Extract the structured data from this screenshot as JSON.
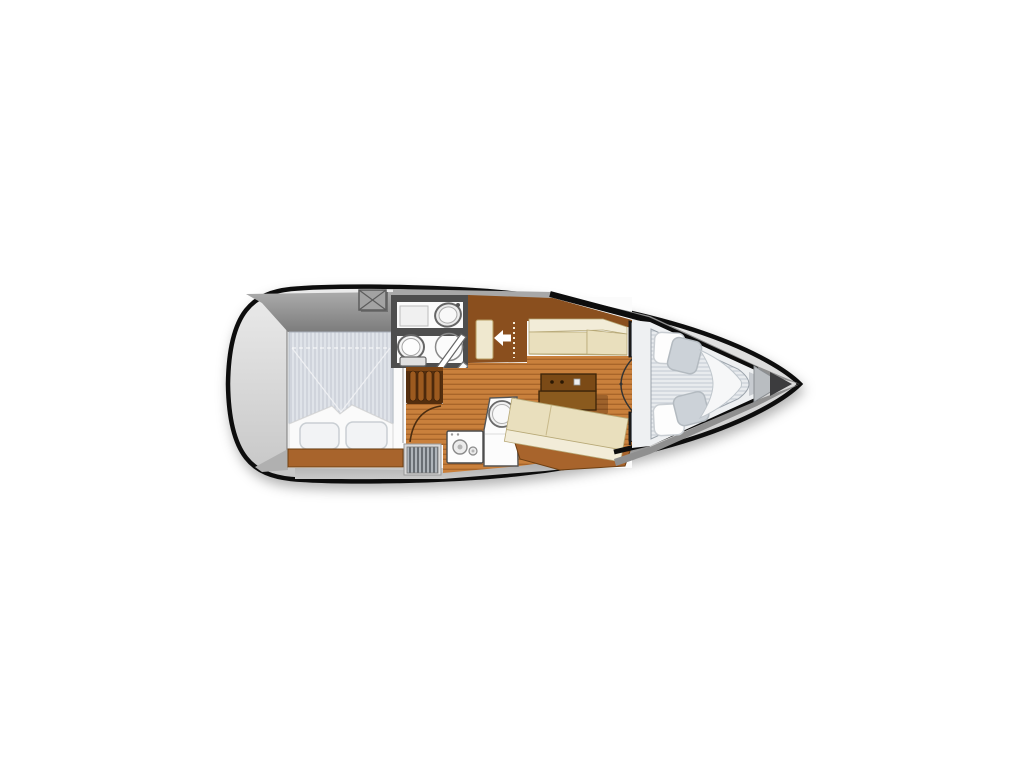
{
  "diagram": {
    "type": "sailboat-interior-floor-plan",
    "orientation": "top-down, bow pointing right",
    "areas": [
      "aft double cabin with striped berth and two pillows",
      "wet head with vanity sink, marine toilet and shower door",
      "companionway steps with white entry arrow",
      "wardrobe locker with cream door",
      "salon with port settee, drop-leaf table and starboard settee",
      "galley with round sink and two-burner stove",
      "forward V-berth with four pillows and folded sheet",
      "anchor locker and bow tip",
      "cockpit deck hatch aft"
    ]
  },
  "icons": {
    "entry_arrow": "left-pointing entry arrow at companionway",
    "deck_hatch": "square hatch with X cross"
  },
  "colors": {
    "page_bg": "#ffffff",
    "hull_outline": "#0d0d0d",
    "hull_top": "#ebebeb",
    "hull_bottom": "#c6c6c6",
    "cockpit_top": "#ababab",
    "cockpit_bottom": "#7c7c7c",
    "band_top": "#8d8d8d",
    "band_bottom": "#c9c9c9",
    "deck_gray": "#8f8f8f",
    "strip_gray": "#a8a8a8",
    "wall_gray": "#4e4e4e",
    "inner_white": "#fbfbfb",
    "floor_base": "#c9803c",
    "floor_line": "#a8652a",
    "wood_trim": "#a8642c",
    "wood_edge": "#6e3f12",
    "cabinet_brown": "#8a4f1e",
    "steps_dark": "#542e0e",
    "steps_bar": "#9c5a1f",
    "table_top": "#8a5a1e",
    "table_drawer": "#7b4a16",
    "table_outline": "#3a2309",
    "cushion_seat": "#e9dfbd",
    "cushion_back": "#f2ecd8",
    "cushion_edge": "#b7a876",
    "door_cream": "#efe8cf",
    "mattress_base": "#dfe3e9",
    "mattress_line": "#c3c9d3",
    "vmattress_base": "#e8ebee",
    "vmattress_line": "#c6ccd4",
    "pillow_white": "#fdfdfd",
    "pillow_gray": "#ccd2d8",
    "sheet_white": "#f6f7f8",
    "fixture_white": "#f5f5f5",
    "fixture_stroke": "#666666",
    "locker_dark": "#3f3f45",
    "locker_stripe": "#9aa0a8",
    "vent_base": "#aeb4ba",
    "vent_stripe": "#50565c",
    "anchor_gray": "#b9bdc1",
    "foredeck_gray": "#c7cbd0",
    "bow_dark": "#3c3c3e",
    "arrow_white": "#ffffff",
    "hatch_gray": "#a3a3a3",
    "hatch_edge": "#5c5c5c"
  }
}
